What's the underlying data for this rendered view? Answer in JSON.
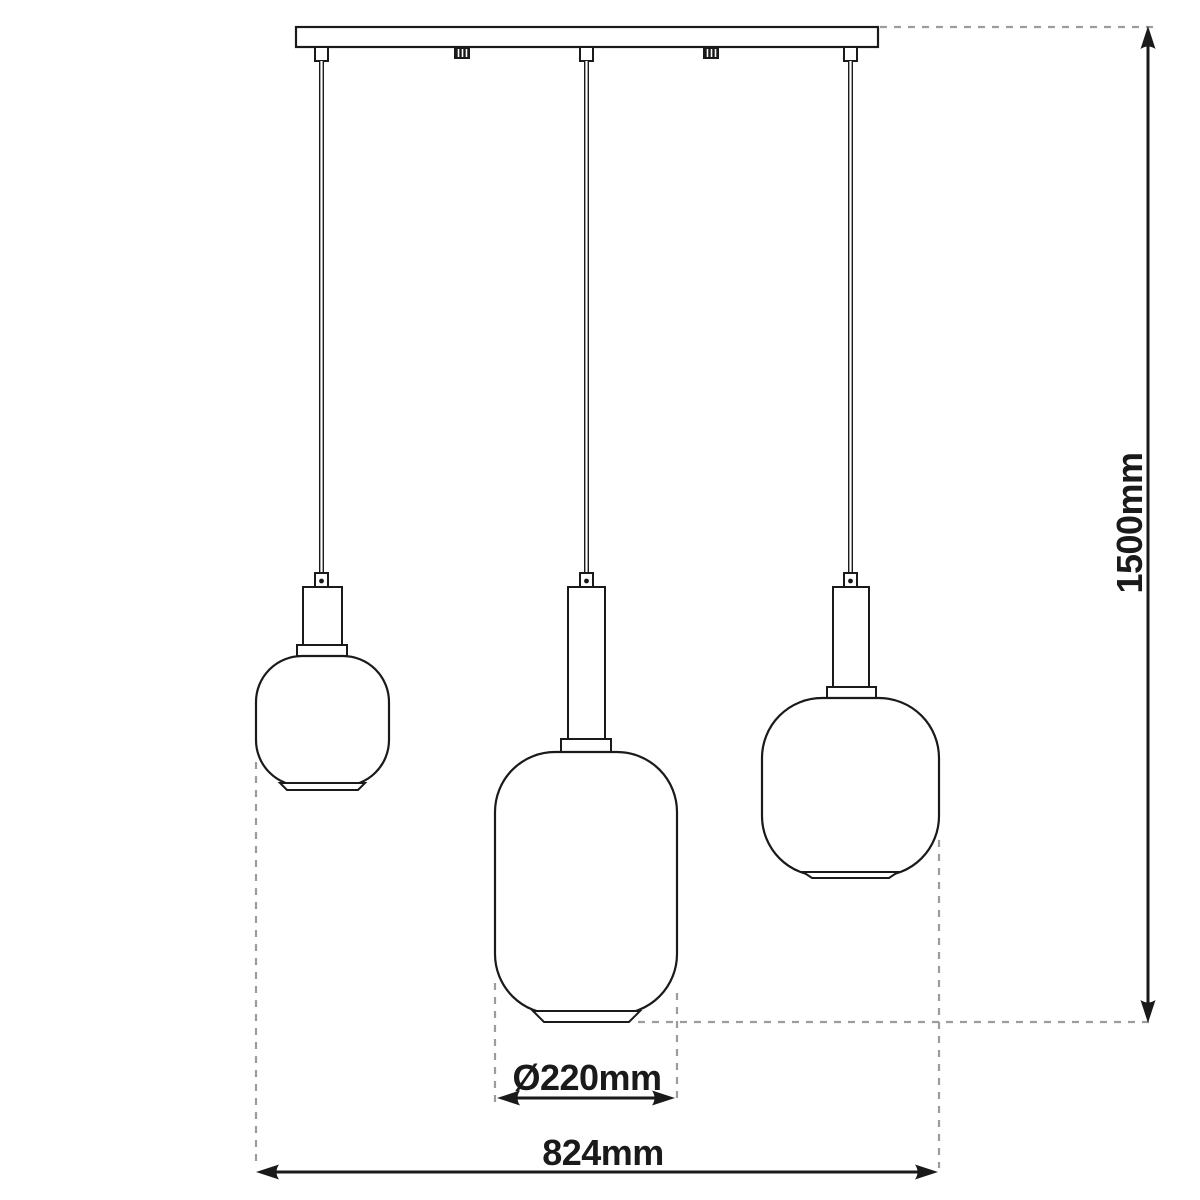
{
  "diagram": {
    "kind": "pendant-lamp-technical-dimension-drawing",
    "dimensions": {
      "height_label": "1500mm",
      "shade_diameter_label": "Ø220mm",
      "overall_width_label": "824mm"
    },
    "colors": {
      "line": "#1a1a1a",
      "dash": "#9c9c9c",
      "bg": "#ffffff"
    }
  }
}
